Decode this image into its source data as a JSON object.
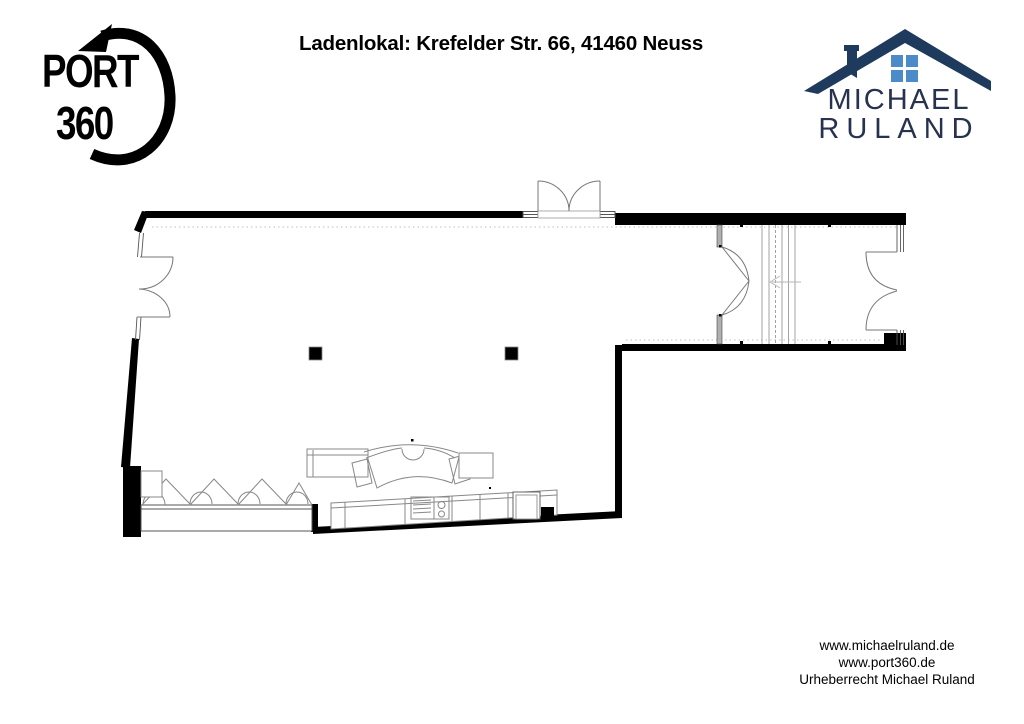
{
  "header": {
    "title": "Ladenlokal: Krefelder Str. 66, 41460 Neuss"
  },
  "logo_port360": {
    "line1": "PORT",
    "line2": "360",
    "icon": "circular-arrow-icon",
    "color": "#000000"
  },
  "logo_michael_ruland": {
    "line1": "MICHAEL",
    "line2": "RULAND",
    "icon": "house-icon",
    "roof_color": "#1e3a5c",
    "window_color": "#4c8bca",
    "text_color": "#26324f"
  },
  "footer": {
    "line1": "www.michaelruland.de",
    "line2": "www.port360.de",
    "line3": "Urheberrecht Michael Ruland"
  },
  "floor_plan": {
    "wall_color": "#000000",
    "line_color": "#777777"
  }
}
